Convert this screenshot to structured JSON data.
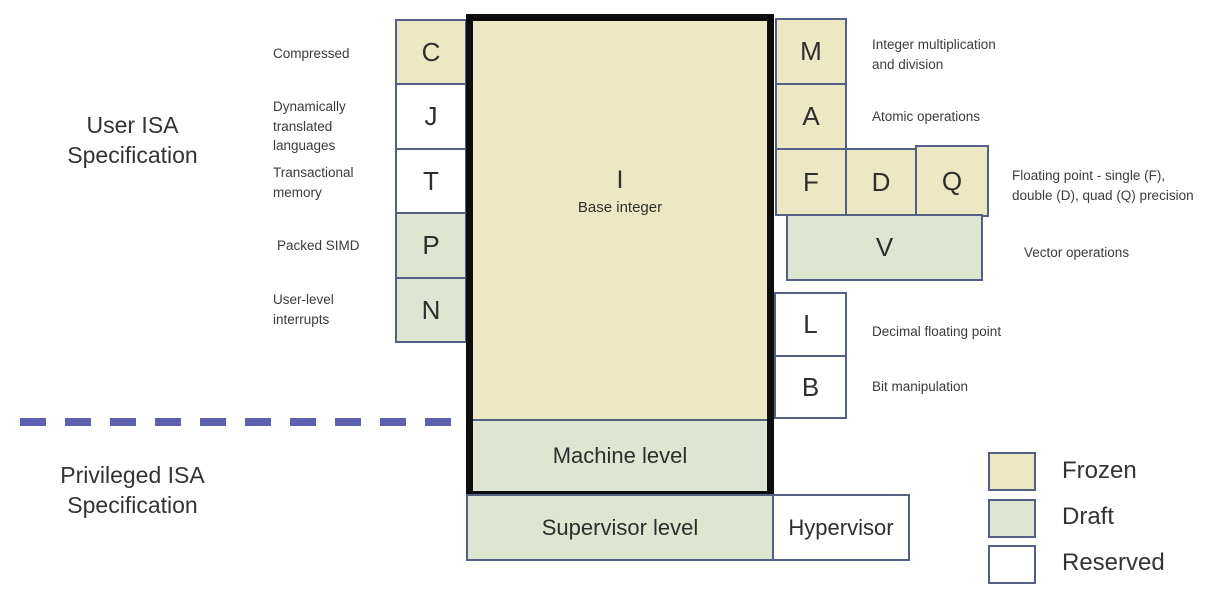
{
  "colors": {
    "frozen": "#ece8c3",
    "draft": "#dee6d2",
    "reserved": "#ffffff",
    "box_border": "#545f85",
    "thick_border": "#0d0d0d",
    "divider": "#5c60ae",
    "text": "#3b3b3b"
  },
  "section_titles": {
    "user": "User ISA\nSpecification",
    "privileged": "Privileged ISA\nSpecification"
  },
  "base": {
    "letter": "I",
    "label": "Base integer"
  },
  "levels": {
    "machine": "Machine level",
    "supervisor": "Supervisor level",
    "hypervisor": "Hypervisor"
  },
  "left_extensions": [
    {
      "letter": "C",
      "status": "frozen",
      "label": "Compressed"
    },
    {
      "letter": "J",
      "status": "reserved",
      "label": "Dynamically\ntranslated\nlanguages"
    },
    {
      "letter": "T",
      "status": "reserved",
      "label": "Transactional\nmemory"
    },
    {
      "letter": "P",
      "status": "draft",
      "label": "Packed SIMD"
    },
    {
      "letter": "N",
      "status": "draft",
      "label": "User-level\ninterrupts"
    }
  ],
  "right_extensions": [
    {
      "letter": "M",
      "status": "frozen",
      "label": "Integer multiplication\nand division"
    },
    {
      "letter": "A",
      "status": "frozen",
      "label": "Atomic operations"
    },
    {
      "letter": "F",
      "status": "frozen",
      "label": ""
    },
    {
      "letter": "D",
      "status": "frozen",
      "label": ""
    },
    {
      "letter": "Q",
      "status": "frozen",
      "label": ""
    },
    {
      "letter": "V",
      "status": "draft",
      "label": "Vector operations"
    },
    {
      "letter": "L",
      "status": "reserved",
      "label": "Decimal floating point"
    },
    {
      "letter": "B",
      "status": "reserved",
      "label": "Bit manipulation"
    }
  ],
  "fdq_label": "Floating point - single (F),\ndouble (D), quad (Q) precision",
  "legend": [
    {
      "label": "Frozen",
      "status": "frozen"
    },
    {
      "label": "Draft",
      "status": "draft"
    },
    {
      "label": "Reserved",
      "status": "reserved"
    }
  ]
}
